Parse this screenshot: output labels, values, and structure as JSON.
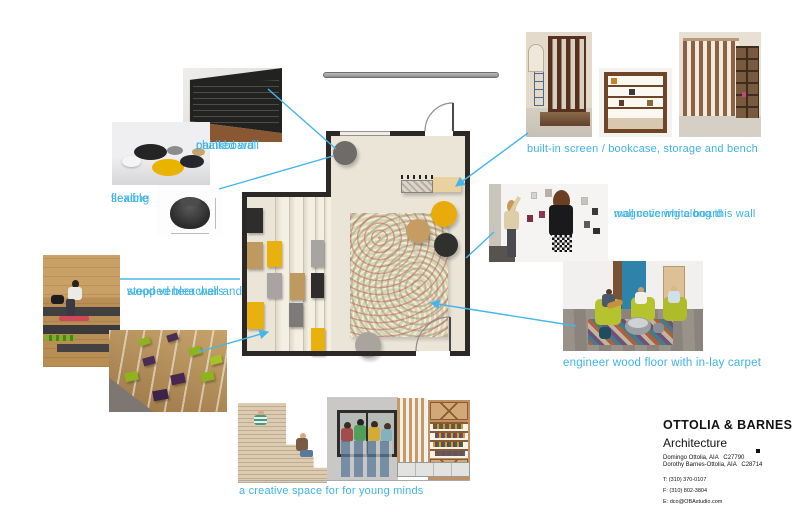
{
  "board": {
    "accent_color": "#3eb3e7",
    "plan_colors": {
      "floor": "#ebe5d8",
      "wall": "#2b2825",
      "pouf_yellow": "#e9ab0c",
      "pouf_tan": "#c69c63",
      "pouf_charcoal": "#30302e",
      "pouf_gray": "#6e6b68",
      "carpet_base": "#d9d3b9"
    }
  },
  "annotations": {
    "chalkboard": {
      "line1": "chalkboard",
      "line2": "painted wall"
    },
    "flexible": {
      "line1": "flexible",
      "line2": "seating"
    },
    "wood_veneer": {
      "line1": "wood veneer wall and",
      "line2": "stepped bleachers"
    },
    "built_in": {
      "text": "built-in screen / bookcase, storage and bench"
    },
    "magnetic": {
      "line1": "magnetic white board",
      "line2": "wall covering along this wall"
    },
    "floor": {
      "text": "engineer wood floor with in-lay carpet"
    },
    "tagline": {
      "text": "a creative space for for young minds"
    }
  },
  "title_block": {
    "firm": "OTTOLIA & BARNES",
    "discipline": "Architecture",
    "license_1": "Domingo Ottolia, AIA   C27790",
    "license_2": "Dorothy Barnes-Ottolia, AIA   C28714",
    "phone": "T: (310) 370-0107",
    "fax": "F: (310) 802-3804",
    "email": "E: dco@OBAstudio.com"
  }
}
